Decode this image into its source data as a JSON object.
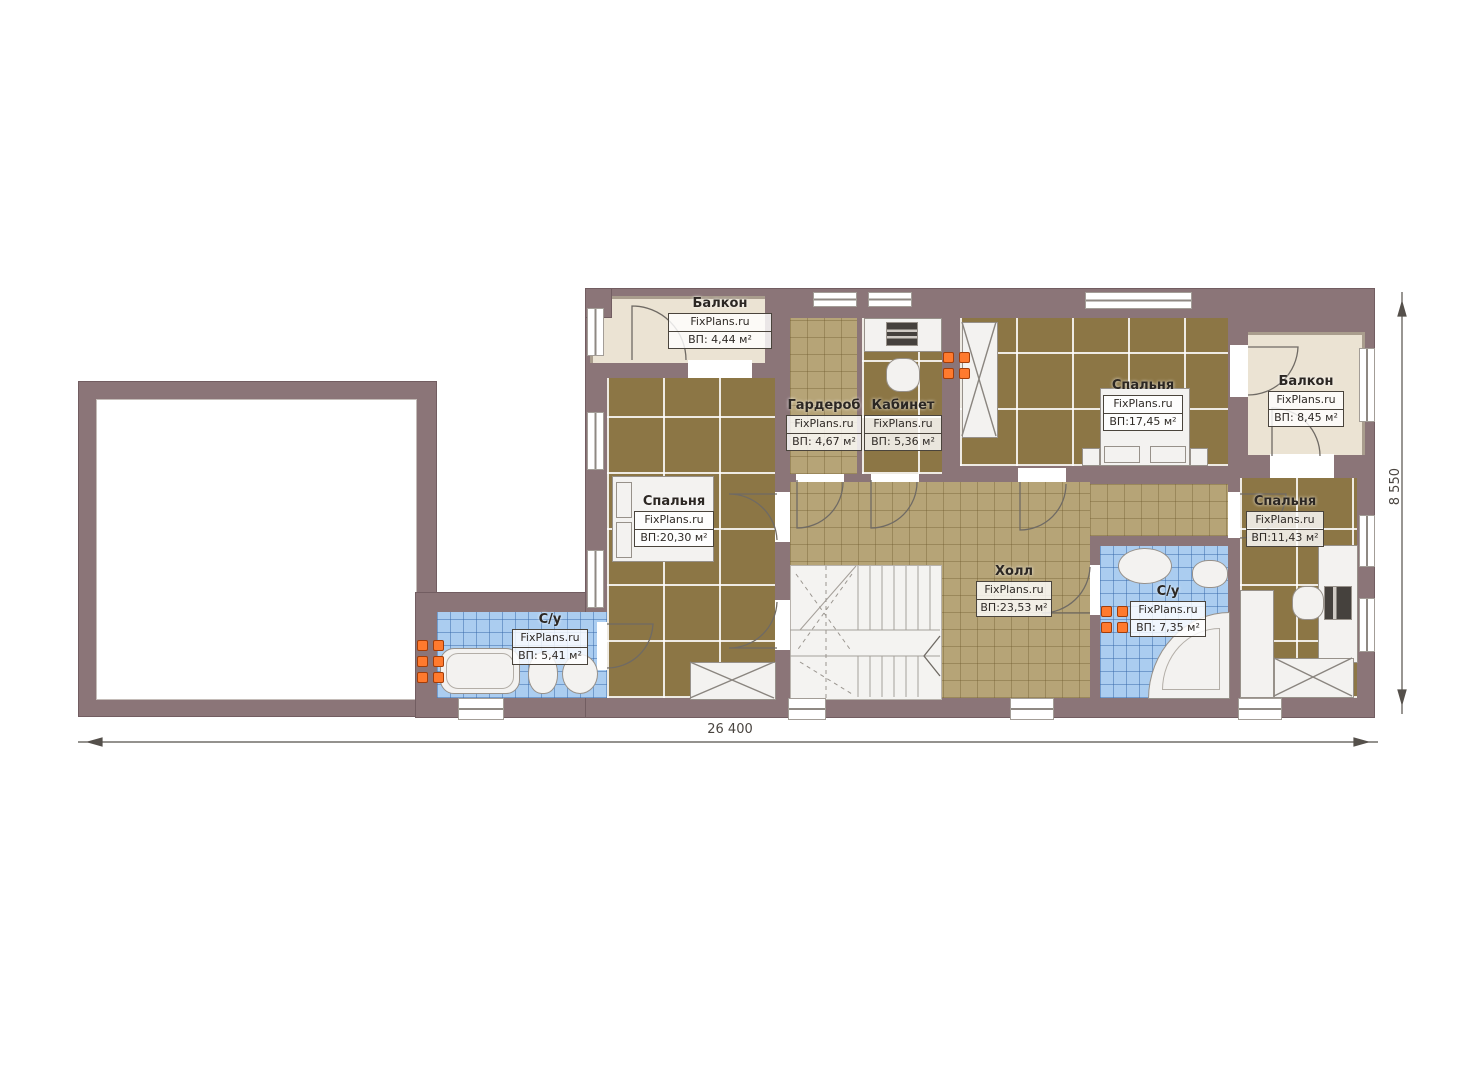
{
  "brand": "FixPlans.ru",
  "rooms": [
    {
      "key": "balcony-left",
      "name": "Балкон",
      "area": "ВП: 4,44 м²"
    },
    {
      "key": "wardrobe",
      "name": "Гардероб",
      "area": "ВП: 4,67 м²"
    },
    {
      "key": "office",
      "name": "Кабинет",
      "area": "ВП: 5,36 м²"
    },
    {
      "key": "bedroom-top",
      "name": "Спальня",
      "area": "ВП:17,45 м²"
    },
    {
      "key": "balcony-right",
      "name": "Балкон",
      "area": "ВП: 8,45 м²"
    },
    {
      "key": "bedroom-left",
      "name": "Спальня",
      "area": "ВП:20,30 м²"
    },
    {
      "key": "bedroom-right",
      "name": "Спальня",
      "area": "ВП:11,43 м²"
    },
    {
      "key": "hall",
      "name": "Холл",
      "area": "ВП:23,53 м²"
    },
    {
      "key": "bathroom-right",
      "name": "С/у",
      "area": "ВП: 7,35 м²"
    },
    {
      "key": "bathroom-left",
      "name": "С/у",
      "area": "ВП: 5,41 м²"
    }
  ],
  "dimensions": {
    "width": "26 400",
    "height": "8 550"
  },
  "colors": {
    "wall": "#8b7578",
    "floor_bedroom": "#8c7645",
    "floor_hall": "#b6a477",
    "floor_bath": "#abcdf0",
    "floor_balcony": "#ebe3d3",
    "radiator": "#ff7a2e"
  }
}
